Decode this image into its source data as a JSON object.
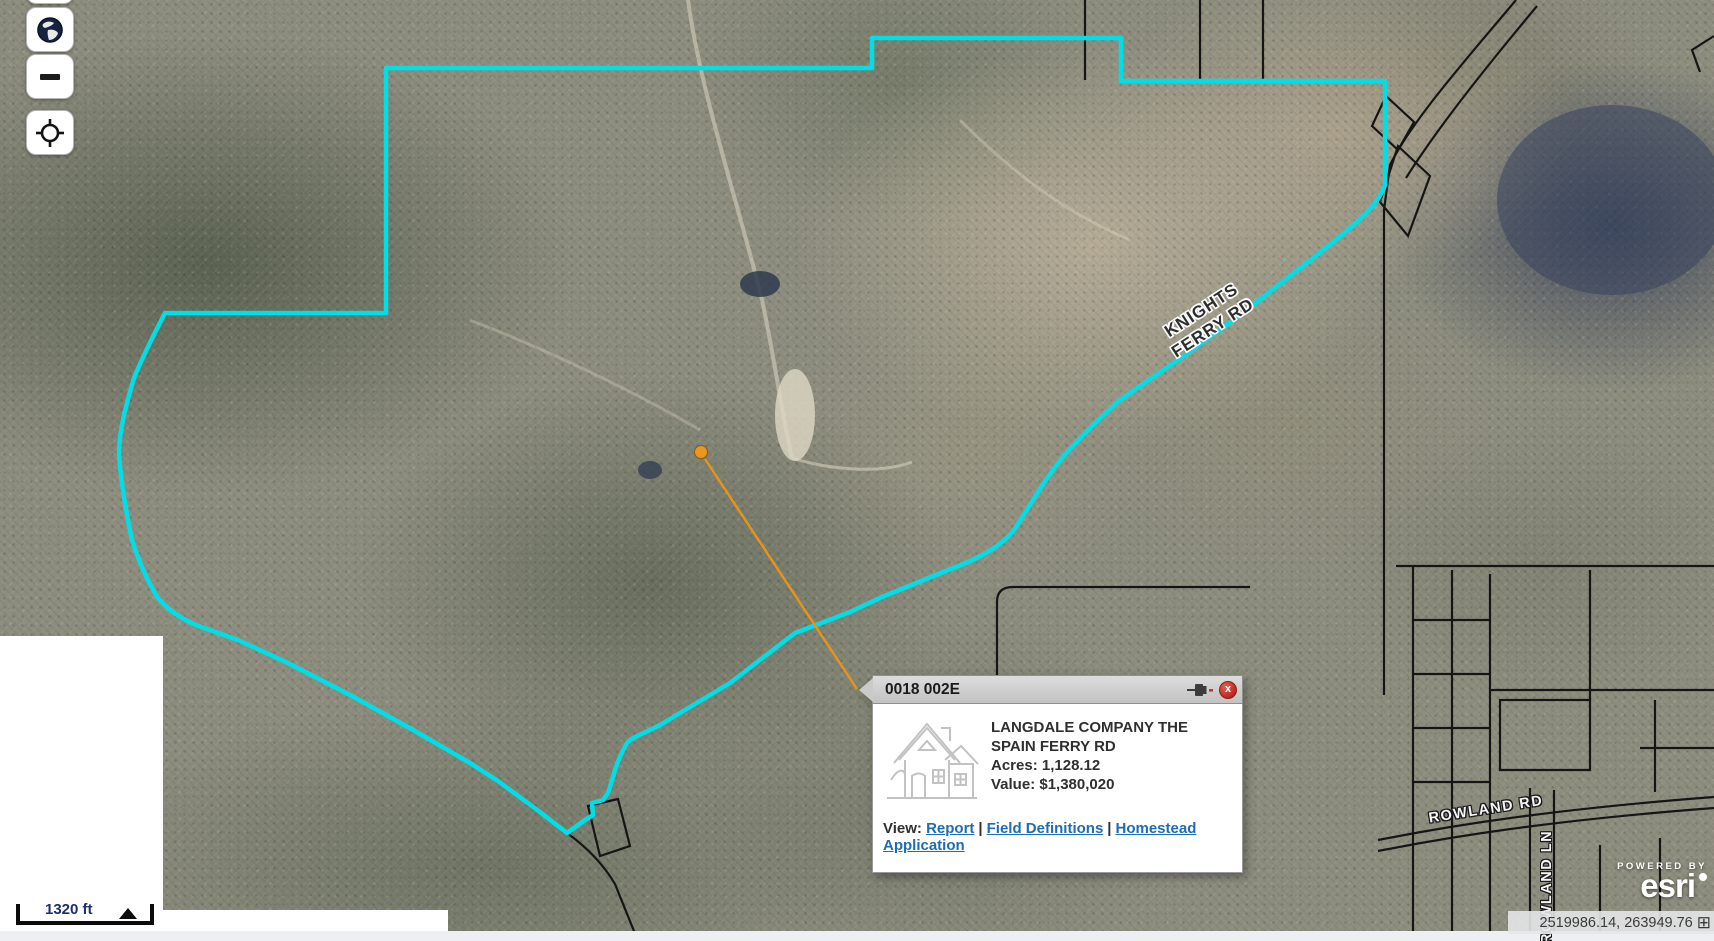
{
  "popup": {
    "title": "0018 002E",
    "owner": "LANGDALE COMPANY THE",
    "address": "SPAIN FERRY RD",
    "acres_label": "Acres:",
    "acres_value": "1,128.12",
    "value_label": "Value:",
    "value_value": "$1,380,020",
    "view_label": "View:",
    "separator": "|",
    "links": [
      "Report",
      "Field Definitions",
      "Homestead Application"
    ]
  },
  "road_labels": {
    "knights_ferry_line1": "KNIGHTS",
    "knights_ferry_line2": "FERRY RD",
    "rowland_rd": "ROWLAND RD",
    "rowland_ln": "ROWLAND LN"
  },
  "scale_bar": {
    "distance": "1320 ft"
  },
  "status_bar": {
    "coordinates": "2519986.14, 263949.76"
  },
  "attribution": {
    "powered_by": "POWERED BY",
    "brand": "esri"
  },
  "icons": {
    "globe": "globe-icon",
    "zoom_out": "minus-icon",
    "locate": "crosshair-locate-icon",
    "pin": "pushpin-icon",
    "close": "close-x-icon",
    "expand": "expand-coordinates-icon"
  },
  "colors": {
    "parcel_outline": "#00dfe8",
    "leader_line": "#e8941a",
    "link_blue": "#1d6cb5",
    "close_red": "#b3271d",
    "popup_header_gray": "#cccccc",
    "scale_text_navy": "#1c2f6e"
  }
}
